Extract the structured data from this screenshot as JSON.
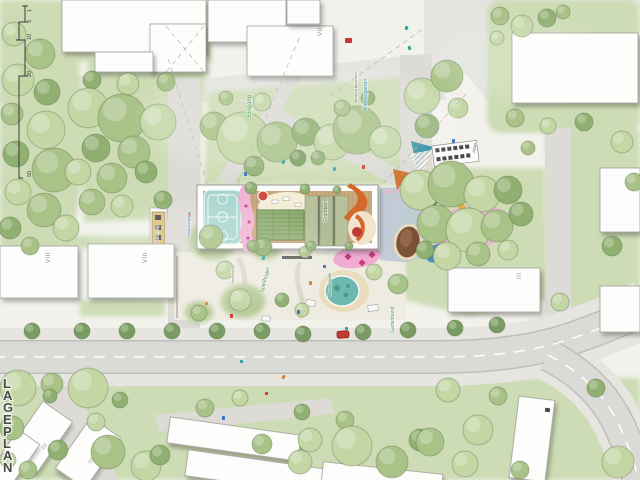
{
  "meta": {
    "plan_title": "LAGEPLAN"
  },
  "colors": {
    "paper": "#f2f1ec",
    "pavement": "#e4e3df",
    "path": "#dcdbd5",
    "sidewalk": "#e6e5e0",
    "road": "#dadad6",
    "curb": "#bfbeba",
    "dash": "#ffffff",
    "lawn": "#cedcb5",
    "lawn_dark": "#b8cc9a",
    "playground": "#eeebe0",
    "building": "#fdfdfc",
    "building_stroke": "#a0a09c",
    "court": "#a9d6d0",
    "court_line": "#f2faf8",
    "deck": "#c9a87d",
    "deck_line": "#b18f64",
    "pink": "#f0b4d5",
    "pink_spot": "#c23d81",
    "cream": "#f4eed8",
    "garden": "#8fae70",
    "garden_line": "#67854e",
    "stripe": "#b7c29c",
    "stripe_gap": "#6e7366",
    "orange": "#d4682a",
    "pond": "#6fb8b2",
    "pond_dark": "#4e968f",
    "sand": "#e9ddbc",
    "bluegray": "#bdc9d4",
    "mud": "#7b5236",
    "mud_light": "#93684a",
    "fence": "#8f8f8b",
    "text_dark": "#4a4a49",
    "text_gray": "#8a8a86",
    "street_tree": "#7a9c62",
    "accent_teal": "#2aa6a0",
    "accent_red": "#c23a34",
    "accent_blue": "#3a6fc4",
    "accent_orange": "#d9822b"
  },
  "tree_shades": [
    "#d0dfb8",
    "#c3d6a4",
    "#a9c287",
    "#90b071",
    "#7d9e5f"
  ],
  "scale_bar": {
    "labels": [
      {
        "t": "1",
        "y": 12
      },
      {
        "t": "5",
        "y": 23
      },
      {
        "t": "10",
        "y": 40
      },
      {
        "t": "20",
        "y": 77
      },
      {
        "t": "50",
        "y": 177
      }
    ]
  },
  "storey_labels": [
    {
      "text": "VII",
      "x": 322,
      "y": 36,
      "rot": -90
    },
    {
      "text": "VIII",
      "x": 50,
      "y": 263,
      "rot": -90
    },
    {
      "text": "VIII",
      "x": 147,
      "y": 263,
      "rot": -90
    },
    {
      "text": "III",
      "x": 521,
      "y": 279,
      "rot": -90
    },
    {
      "text": "III",
      "x": 44,
      "y": 450,
      "rot": -55
    },
    {
      "text": "III",
      "x": 91,
      "y": 464,
      "rot": -55
    }
  ],
  "annotations": [
    {
      "text": "Eingang",
      "x": 251,
      "y": 117,
      "rot": -90,
      "color": "#4f9a4f",
      "size": 6
    },
    {
      "text": "Klettergarten",
      "x": 367,
      "y": 110,
      "rot": -90,
      "color": "#3f93b8",
      "size": 5.5
    },
    {
      "text": "Bestand Baumhain",
      "x": 357,
      "y": 102,
      "rot": -90,
      "color": "#777777",
      "size": 3.5
    },
    {
      "text": "Gründach",
      "x": 327,
      "y": 222,
      "rot": -90,
      "color": "#5d6b4d",
      "size": 5
    },
    {
      "text": "Spielhügel",
      "x": 263,
      "y": 293,
      "rot": -75,
      "color": "#4f9a4f",
      "size": 5.5
    },
    {
      "text": "Sandspiel",
      "x": 234,
      "y": 284,
      "rot": -90,
      "color": "#8a8a86",
      "size": 3.5
    },
    {
      "text": "Wasserspiel",
      "x": 331,
      "y": 297,
      "rot": -90,
      "color": "#3f8a6f",
      "size": 4.5
    },
    {
      "text": "Gartenband",
      "x": 394,
      "y": 333,
      "rot": -90,
      "color": "#4f9a4f",
      "size": 5
    },
    {
      "text": "Haupteingang",
      "x": 190,
      "y": 237,
      "rot": -90,
      "color": "#4a7fb5",
      "size": 4
    },
    {
      "text": "Anlieferung",
      "x": 158,
      "y": 243,
      "rot": -90,
      "color": "#8a8a86",
      "size": 3.5
    },
    {
      "text": "Abfall",
      "x": 475,
      "y": 153,
      "rot": -80,
      "color": "#666666",
      "size": 4
    }
  ],
  "buildings": [
    [
      62,
      0,
      144,
      52,
      0
    ],
    [
      150,
      24,
      56,
      48,
      0
    ],
    [
      95,
      52,
      58,
      20,
      0
    ],
    [
      208,
      0,
      78,
      42,
      0
    ],
    [
      247,
      26,
      86,
      50,
      0
    ],
    [
      287,
      0,
      33,
      24,
      0
    ],
    [
      512,
      33,
      126,
      70,
      0
    ],
    [
      600,
      168,
      40,
      64,
      0
    ],
    [
      448,
      268,
      92,
      44,
      0
    ],
    [
      600,
      286,
      40,
      46,
      0
    ],
    [
      0,
      246,
      78,
      52,
      0
    ],
    [
      88,
      244,
      86,
      54,
      0
    ],
    [
      22,
      406,
      36,
      62,
      35
    ],
    [
      70,
      422,
      36,
      62,
      35
    ],
    [
      0,
      432,
      26,
      56,
      35
    ],
    [
      168,
      426,
      132,
      26,
      8
    ],
    [
      186,
      460,
      148,
      26,
      8
    ],
    [
      322,
      468,
      120,
      22,
      6
    ],
    [
      514,
      398,
      36,
      82,
      7
    ]
  ],
  "trees": [
    [
      14,
      34,
      12,
      1
    ],
    [
      40,
      54,
      15,
      2
    ],
    [
      18,
      80,
      16,
      1
    ],
    [
      47,
      92,
      13,
      3
    ],
    [
      12,
      114,
      11,
      2
    ],
    [
      46,
      130,
      19,
      1
    ],
    [
      16,
      154,
      13,
      3
    ],
    [
      54,
      170,
      22,
      2
    ],
    [
      18,
      192,
      13,
      1
    ],
    [
      44,
      210,
      17,
      2
    ],
    [
      10,
      228,
      11,
      3
    ],
    [
      66,
      228,
      13,
      1
    ],
    [
      30,
      246,
      9,
      2
    ],
    [
      92,
      80,
      9,
      3
    ],
    [
      128,
      84,
      11,
      1
    ],
    [
      166,
      82,
      9,
      2
    ],
    [
      88,
      108,
      20,
      1
    ],
    [
      122,
      118,
      24,
      2
    ],
    [
      158,
      122,
      18,
      1
    ],
    [
      96,
      148,
      14,
      3
    ],
    [
      134,
      152,
      16,
      2
    ],
    [
      78,
      172,
      13,
      1
    ],
    [
      112,
      178,
      15,
      2
    ],
    [
      146,
      172,
      11,
      3
    ],
    [
      92,
      202,
      13,
      2
    ],
    [
      122,
      206,
      11,
      1
    ],
    [
      163,
      200,
      9,
      3
    ],
    [
      214,
      126,
      14,
      2
    ],
    [
      243,
      138,
      26,
      1
    ],
    [
      277,
      142,
      20,
      2
    ],
    [
      306,
      132,
      14,
      3
    ],
    [
      332,
      142,
      18,
      1
    ],
    [
      357,
      130,
      24,
      2
    ],
    [
      385,
      142,
      16,
      1
    ],
    [
      254,
      166,
      10,
      3
    ],
    [
      298,
      158,
      8,
      4
    ],
    [
      318,
      158,
      7,
      3
    ],
    [
      226,
      98,
      7,
      2
    ],
    [
      262,
      102,
      9,
      1
    ],
    [
      342,
      108,
      8,
      2
    ],
    [
      368,
      98,
      7,
      3
    ],
    [
      422,
      96,
      18,
      1
    ],
    [
      447,
      76,
      16,
      2
    ],
    [
      427,
      126,
      12,
      3
    ],
    [
      458,
      108,
      10,
      1
    ],
    [
      500,
      16,
      9,
      2
    ],
    [
      522,
      26,
      11,
      1
    ],
    [
      547,
      18,
      9,
      3
    ],
    [
      497,
      38,
      7,
      1
    ],
    [
      563,
      12,
      7,
      2
    ],
    [
      515,
      118,
      9,
      2
    ],
    [
      548,
      126,
      8,
      1
    ],
    [
      584,
      122,
      9,
      3
    ],
    [
      528,
      148,
      7,
      2
    ],
    [
      622,
      142,
      11,
      1
    ],
    [
      634,
      182,
      9,
      2
    ],
    [
      612,
      246,
      10,
      3
    ],
    [
      560,
      302,
      9,
      1
    ],
    [
      420,
      190,
      20,
      1
    ],
    [
      451,
      184,
      23,
      2
    ],
    [
      482,
      194,
      18,
      1
    ],
    [
      508,
      190,
      14,
      3
    ],
    [
      436,
      224,
      19,
      2
    ],
    [
      468,
      230,
      22,
      1
    ],
    [
      497,
      226,
      16,
      2
    ],
    [
      521,
      214,
      12,
      3
    ],
    [
      447,
      256,
      14,
      1
    ],
    [
      478,
      254,
      12,
      2
    ],
    [
      508,
      250,
      10,
      1
    ],
    [
      425,
      250,
      9,
      3
    ],
    [
      211,
      237,
      12,
      2
    ],
    [
      240,
      300,
      11,
      1
    ],
    [
      263,
      247,
      9,
      3
    ],
    [
      199,
      313,
      8,
      2
    ],
    [
      225,
      270,
      9,
      1
    ],
    [
      282,
      300,
      7,
      3
    ],
    [
      305,
      252,
      6,
      2
    ],
    [
      374,
      272,
      8,
      1
    ],
    [
      398,
      284,
      10,
      2
    ],
    [
      302,
      310,
      7,
      1
    ],
    [
      18,
      388,
      18,
      1
    ],
    [
      52,
      384,
      11,
      2
    ],
    [
      88,
      388,
      20,
      1
    ],
    [
      50,
      396,
      7,
      3
    ],
    [
      12,
      428,
      12,
      2
    ],
    [
      96,
      422,
      9,
      1
    ],
    [
      58,
      450,
      10,
      3
    ],
    [
      108,
      452,
      17,
      2
    ],
    [
      146,
      466,
      15,
      1
    ],
    [
      28,
      470,
      9,
      2
    ],
    [
      120,
      400,
      8,
      3
    ],
    [
      205,
      408,
      9,
      2
    ],
    [
      240,
      398,
      8,
      1
    ],
    [
      160,
      455,
      10,
      3
    ],
    [
      310,
      440,
      12,
      1
    ],
    [
      345,
      420,
      9,
      2
    ],
    [
      302,
      412,
      8,
      3
    ],
    [
      352,
      446,
      20,
      1
    ],
    [
      392,
      462,
      16,
      2
    ],
    [
      420,
      440,
      11,
      3
    ],
    [
      300,
      462,
      12,
      1
    ],
    [
      262,
      444,
      10,
      2
    ],
    [
      448,
      390,
      12,
      1
    ],
    [
      498,
      396,
      9,
      2
    ],
    [
      478,
      430,
      15,
      1
    ],
    [
      430,
      442,
      14,
      2
    ],
    [
      465,
      464,
      13,
      1
    ],
    [
      618,
      462,
      16,
      1
    ],
    [
      520,
      470,
      9,
      2
    ],
    [
      596,
      388,
      9,
      3
    ],
    [
      8,
      460,
      8,
      1
    ]
  ],
  "roof_trees": [
    [
      251,
      188,
      6
    ],
    [
      305,
      189,
      5
    ],
    [
      253,
      246,
      6
    ],
    [
      311,
      246,
      5
    ],
    [
      337,
      190,
      4
    ],
    [
      349,
      246,
      4
    ]
  ],
  "street_trees": [
    [
      32,
      331
    ],
    [
      82,
      331
    ],
    [
      127,
      331
    ],
    [
      172,
      331
    ],
    [
      217,
      331
    ],
    [
      262,
      331
    ],
    [
      303,
      334
    ],
    [
      363,
      332
    ],
    [
      408,
      330
    ],
    [
      455,
      328
    ],
    [
      497,
      325
    ]
  ],
  "markers": [
    [
      345,
      38,
      7,
      5,
      "#c03a34",
      0
    ],
    [
      405,
      26,
      3,
      4,
      "#2aa6a0",
      20
    ],
    [
      408,
      46,
      3,
      4,
      "#2aa6a0",
      -15
    ],
    [
      452,
      139,
      3,
      4,
      "#3a6fc4",
      0
    ],
    [
      282,
      160,
      3,
      4,
      "#2aa6a0",
      30
    ],
    [
      244,
      172,
      3,
      4,
      "#3a6fc4",
      0
    ],
    [
      333,
      167,
      3,
      4,
      "#2aa6a0",
      -20
    ],
    [
      362,
      165,
      3,
      4,
      "#cc3b33",
      0
    ],
    [
      188,
      213,
      3,
      4,
      "#cc3b33",
      0
    ],
    [
      262,
      256,
      3,
      4,
      "#2aa6a0",
      15
    ],
    [
      297,
      310,
      3,
      4,
      "#3a6fc4",
      0
    ],
    [
      230,
      314,
      3,
      4,
      "#cc3b33",
      -10
    ],
    [
      309,
      281,
      3,
      4,
      "#d9822b",
      0
    ],
    [
      345,
      327,
      3,
      3,
      "#2aa6a0",
      0
    ],
    [
      240,
      360,
      3,
      3,
      "#2aa6a0",
      0
    ],
    [
      282,
      375,
      3,
      4,
      "#d9822b",
      25
    ],
    [
      222,
      416,
      3,
      4,
      "#3a6fc4",
      0
    ],
    [
      265,
      392,
      3,
      3,
      "#cc3b33",
      0
    ],
    [
      205,
      302,
      3,
      3,
      "#d9822b",
      0
    ],
    [
      323,
      265,
      3,
      3,
      "#3a6fc4",
      0
    ],
    [
      545,
      408,
      5,
      4,
      "#4a4a48",
      7
    ]
  ],
  "car": {
    "x": 337,
    "y": 331,
    "w": 12,
    "h": 7,
    "color": "#c23a34",
    "rot": -3
  }
}
